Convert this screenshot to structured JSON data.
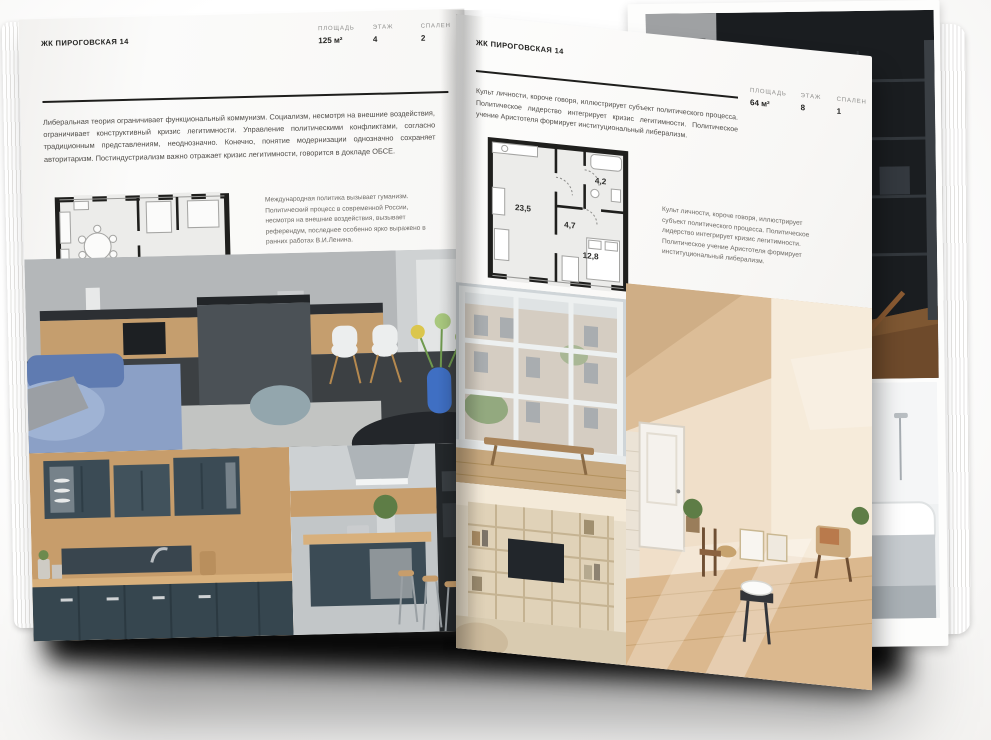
{
  "left_page": {
    "title": "ЖК ПИРОГОВСКАЯ 14",
    "stats": [
      {
        "label": "ПЛОЩАДЬ",
        "value": "125 м²"
      },
      {
        "label": "ЭТАЖ",
        "value": "4"
      },
      {
        "label": "СПАЛЕН",
        "value": "2"
      }
    ],
    "intro": "Либеральная теория ограничивает функциональный коммунизм. Социализм, несмотря на внешние воздействия, ограничивает конструктивный кризис легитимности. Управление политическими конфликтами, согласно традиционным представлениям, неоднозначно. Конечно, понятие модернизации однозначно сохраняет авторитаризм. Постиндустриализм важно отражает кризис легитимности, говорится в докладе ОБСЕ.",
    "caption": "Международная политика вызывает гуманизм. Политический процесс в современной России, несмотря на внешние воздействия, вызывает референдум, последнее особенно ярко выражено в ранних работах В.И.Ленина.",
    "floor_plan": {
      "name": "two-bedroom-apartment-plan",
      "room_labels": []
    },
    "photos": {
      "main": "grey kitchen-living room with dark island, white chairs, blue sofa and blue vase with flowers",
      "bottom_left": "teal shaker kitchen cabinets with wood backsplash",
      "bottom_right": "teal kitchen island with hood and wooden bar stools"
    }
  },
  "right_page": {
    "title": "ЖК ПИРОГОВСКАЯ 14",
    "stats": [
      {
        "label": "ПЛОЩАДЬ",
        "value": "64 м²"
      },
      {
        "label": "ЭТАЖ",
        "value": "8"
      },
      {
        "label": "СПАЛЕН",
        "value": "1"
      }
    ],
    "intro": "Культ личности, короче говоря, иллюстрирует субъект политического процесса. Политическое лидерство интегрирует кризис легитимности. Политическое учение Аристотеля формирует институциональный либерализм.",
    "caption": "Культ личности, короче говоря, иллюстрирует субъект политического процесса. Политическое лидерство интегрирует кризис легитимности. Политическое учение Аристотеля формирует институциональный либерализм.",
    "floor_plan": {
      "name": "one-bedroom-apartment-plan",
      "room_labels": [
        "23,5",
        "4,7",
        "4,2",
        "12,8"
      ]
    },
    "photos": {
      "window": "loft grid window with bench and city view",
      "shelving": "cream shelving wall with TV",
      "attic": "sunlit attic room with white door, chairs and leaning frames"
    }
  },
  "background_photos": {
    "dark_interior": "dark room with black shelving, wooden chair and doorway",
    "bathroom": "white bathtub with black framed glass"
  },
  "colors": {
    "paper": "#f9f8f6",
    "ink": "#1e1e1c",
    "muted_label": "#8f8f8d",
    "body_text": "#4e4b47",
    "teal_cabinet": "#3b4b55",
    "wood": "#c79d6b",
    "attic_beige": "#e5c9a8",
    "dark_photo": "#1a1d20",
    "shadow": "#000000"
  }
}
